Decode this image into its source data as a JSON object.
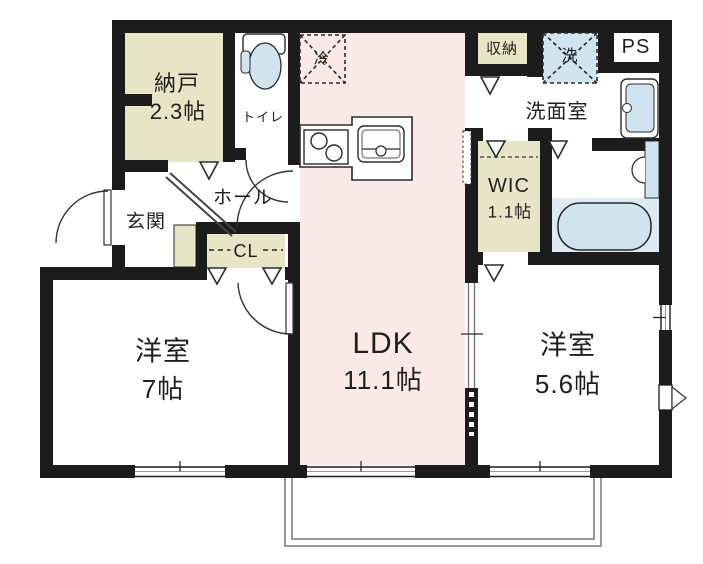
{
  "floor_plan": {
    "title": "1LDK+2S apartment floor plan",
    "rooms": {
      "nando": {
        "name": "納戸",
        "size": "2.3帖"
      },
      "toilet": {
        "name": "トイレ"
      },
      "genkan": {
        "name": "玄関"
      },
      "hall": {
        "name": "ホール"
      },
      "closet": {
        "name": "CL"
      },
      "western_room_7": {
        "name": "洋室",
        "size": "7帖"
      },
      "ldk": {
        "name": "LDK",
        "size": "11.1帖"
      },
      "storage": {
        "name": "収納"
      },
      "washroom": {
        "name": "洗面室"
      },
      "wic": {
        "name": "WIC",
        "size": "1.1帖"
      },
      "western_room_56": {
        "name": "洋室",
        "size": "5.6帖"
      },
      "pipe_space": {
        "name": "PS"
      }
    },
    "fixtures": {
      "refrigerator": {
        "label": "冷"
      },
      "washing_machine": {
        "label": "洗"
      }
    },
    "colors": {
      "wall": "#1c1c1c",
      "room_beige": "#e7e5c6",
      "ldk_pink": "#fbe9e7",
      "fixture_blue": "#cfe4f0",
      "bath_zone_blue": "#dcebf3",
      "balcony_line": "#999999",
      "line": "#2b2b2b"
    }
  }
}
